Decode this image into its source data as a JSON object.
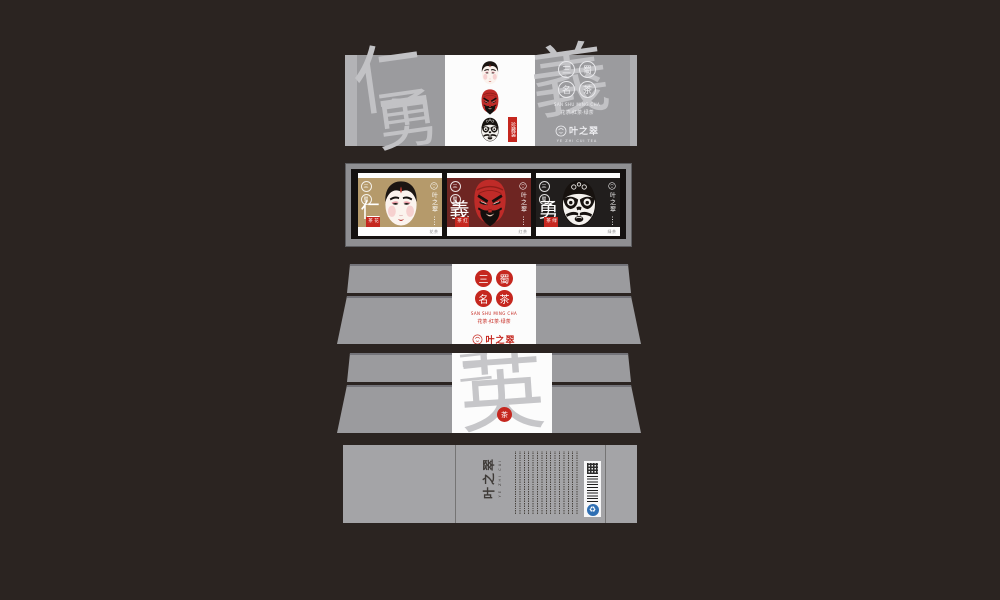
{
  "colors": {
    "background": "#2b2421",
    "panel_gray": "#9b9b9e",
    "accent_red": "#c5271f",
    "card_gold": "#b59a6b",
    "card_crimson": "#6e2522",
    "card_black": "#211e1d"
  },
  "brand": {
    "name": "叶之翠",
    "latin": "YE ZHI CUI TEA",
    "emblem": "opera-face-emblem"
  },
  "seals": {
    "c1": "三",
    "c2": "蜀",
    "c3": "名",
    "c4": "茶",
    "pinyin": "SAN SHU MING CHA",
    "teas": "花茶·红茶·绿茶"
  },
  "sleeve": {
    "watermark_1": "仁",
    "watermark_2": "勇",
    "watermark_3": "義",
    "tag": "珍藏装"
  },
  "tray": {
    "cards": [
      {
        "virtue": "仁",
        "tea": "花茶",
        "mask": "white-face"
      },
      {
        "virtue": "義",
        "tea": "红茶",
        "mask": "red-face"
      },
      {
        "virtue": "勇",
        "tea": "绿茶",
        "mask": "black-face"
      }
    ]
  },
  "lid_back": {
    "watermark_1": "三",
    "watermark_2": "英",
    "seal": "茶"
  },
  "bottom": {
    "brand": "叶之翠",
    "latin": "YE ZHI CUI",
    "eco_icon": "♻"
  }
}
